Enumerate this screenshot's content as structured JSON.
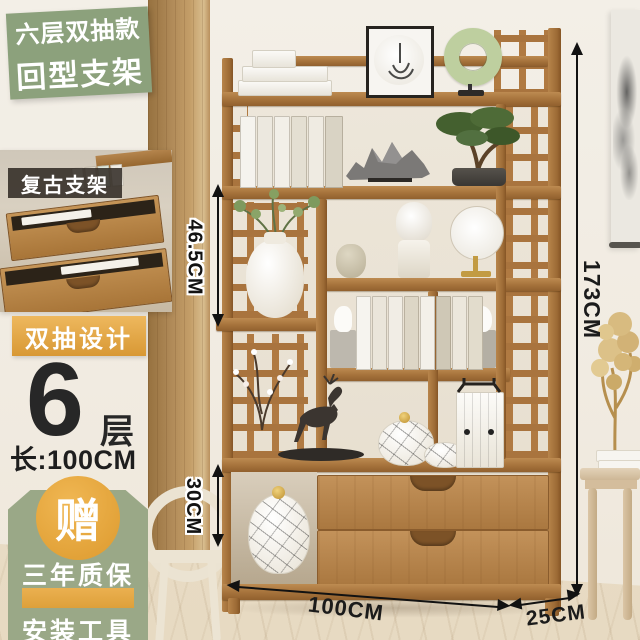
{
  "badges": {
    "top_line1": "六层双抽款",
    "top_line2": "回型支架",
    "retro_label": "复古支架",
    "double_drawer_label": "双抽设计",
    "layers": {
      "number": "6",
      "unit": "层",
      "length": "长:100CM"
    },
    "gift": {
      "char": "赠",
      "warranty": "三年质保",
      "tools": "安装工具"
    }
  },
  "dimensions": {
    "upper_shelf_height": "46.5CM",
    "drawer_height": "30CM",
    "total_height": "173CM",
    "width": "100CM",
    "depth": "25CM"
  },
  "colors": {
    "badge_green": "#8ca17c",
    "tag_green": "#9aa887",
    "badge_gold": "#dfa243",
    "label_dark": "rgba(38,32,26,0.82)",
    "wood": "#a5723b",
    "wall": "#f1ebe1",
    "dimension_line": "#121212"
  }
}
